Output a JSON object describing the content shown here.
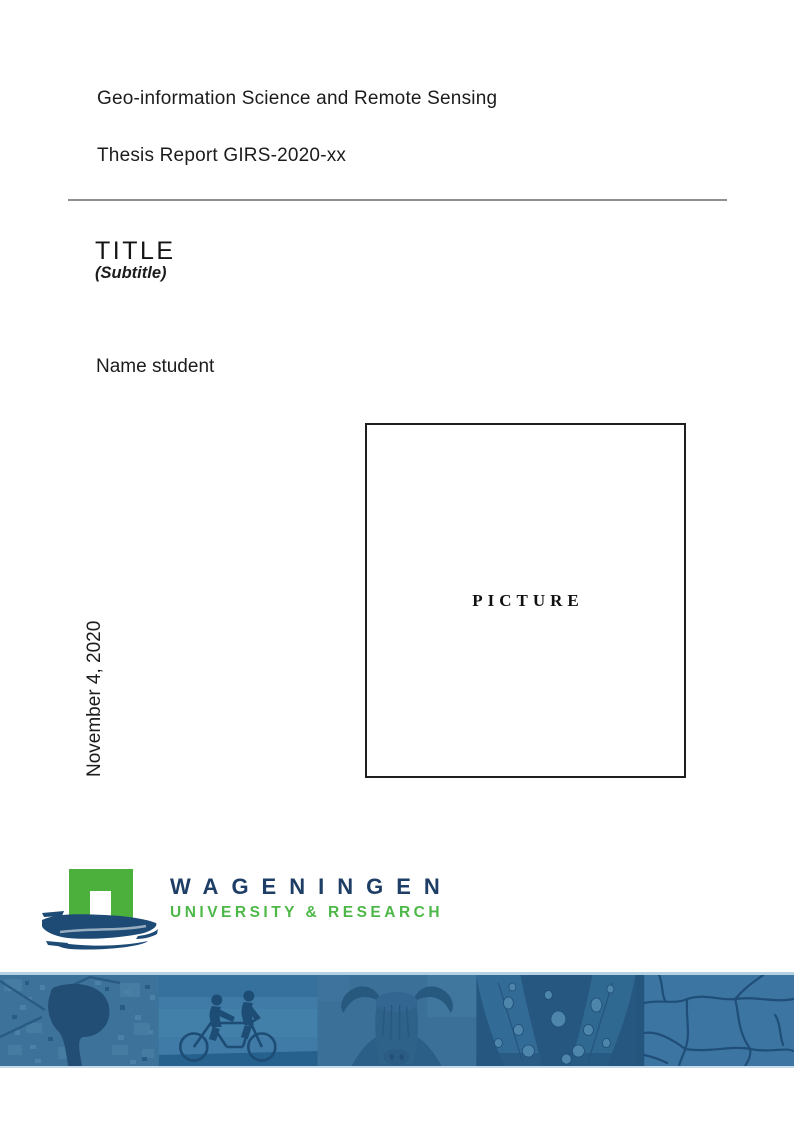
{
  "document": {
    "program": "Geo-information Science and Remote Sensing",
    "report": "Thesis Report GIRS-2020-xx",
    "title": "TITLE",
    "subtitle": "(Subtitle)",
    "author": "Name student",
    "date": "November 4, 2020",
    "picture_placeholder": "PICTURE"
  },
  "logo": {
    "wordmark": "WAGENINGEN",
    "tagline": "UNIVERSITY & RESEARCH",
    "colors": {
      "gable_green": "#4bb03c",
      "brush_blue": "#1d4b76",
      "wordmark_blue": "#1e3e66",
      "tagline_green": "#4db848"
    }
  },
  "footer_banner": {
    "tint_color": "#336c97",
    "edge_line_color": "#b5d2e3",
    "photos": [
      "aerial-map-photo",
      "tandem-cyclists-photo",
      "highland-cow-photo",
      "water-droplets-photo",
      "cracked-earth-photo"
    ]
  }
}
